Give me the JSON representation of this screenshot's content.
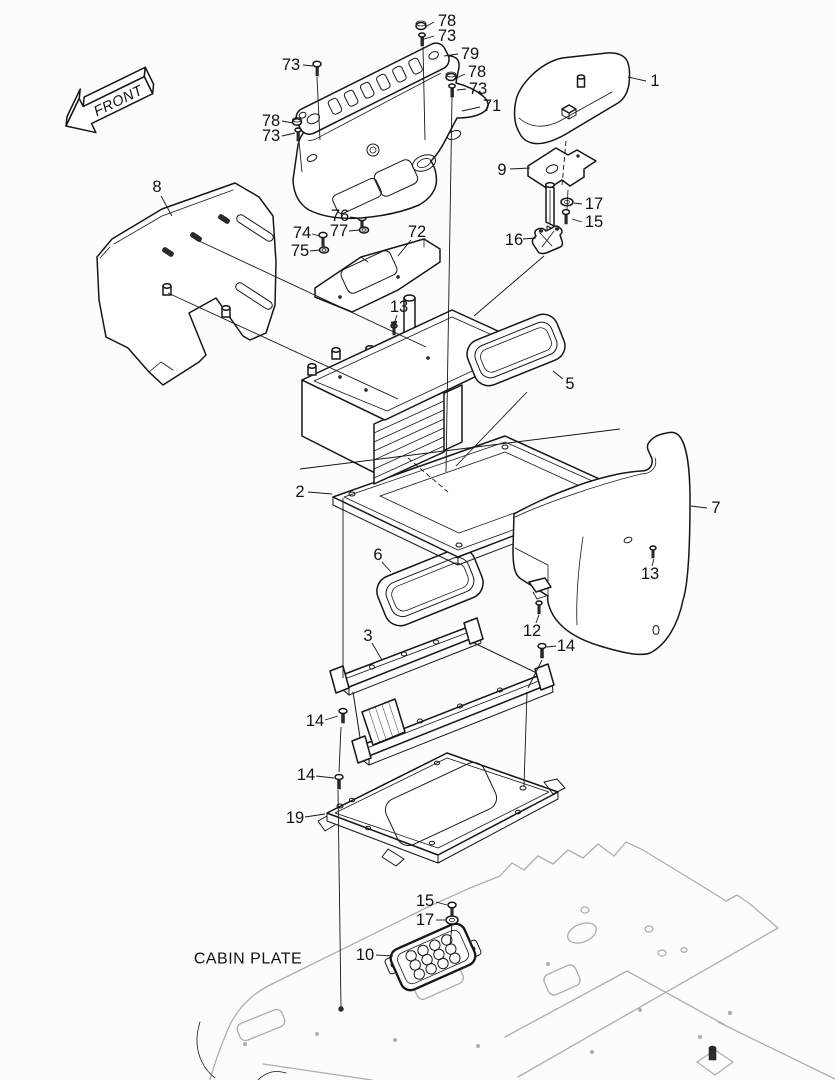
{
  "diagram": {
    "front_arrow_label": "FRONT",
    "cabin_plate_label": "CABIN PLATE",
    "colors": {
      "line": "#161616",
      "cabin_plate_line": "#aeaeae",
      "background": "#fcfcfc"
    },
    "part_labels": [
      {
        "text": "78",
        "tx": 447,
        "ty": 21,
        "lx1": 434,
        "ly1": 22,
        "lx2": 425,
        "ly2": 27
      },
      {
        "text": "73",
        "tx": 447,
        "ty": 36,
        "lx1": 434,
        "ly1": 36,
        "lx2": 424,
        "ly2": 39
      },
      {
        "text": "79",
        "tx": 470,
        "ty": 54,
        "lx1": 458,
        "ly1": 54,
        "lx2": 444,
        "ly2": 56
      },
      {
        "text": "73",
        "tx": 291,
        "ty": 65,
        "lx1": 303,
        "ly1": 65,
        "lx2": 313,
        "ly2": 66
      },
      {
        "text": "78",
        "tx": 477,
        "ty": 72,
        "lx1": 465,
        "ly1": 74,
        "lx2": 454,
        "ly2": 79
      },
      {
        "text": "73",
        "tx": 478,
        "ty": 89,
        "lx1": 466,
        "ly1": 89,
        "lx2": 457,
        "ly2": 90
      },
      {
        "text": "71",
        "tx": 492,
        "ty": 106,
        "lx1": 480,
        "ly1": 107,
        "lx2": 462,
        "ly2": 111
      },
      {
        "text": "78",
        "tx": 271,
        "ty": 121,
        "lx1": 282,
        "ly1": 121,
        "lx2": 293,
        "ly2": 123
      },
      {
        "text": "73",
        "tx": 271,
        "ty": 136,
        "lx1": 282,
        "ly1": 136,
        "lx2": 295,
        "ly2": 133
      },
      {
        "text": "1",
        "tx": 655,
        "ty": 81,
        "lx1": 646,
        "ly1": 81,
        "lx2": 628,
        "ly2": 77
      },
      {
        "text": "9",
        "tx": 502,
        "ty": 170,
        "lx1": 510,
        "ly1": 169,
        "lx2": 530,
        "ly2": 168
      },
      {
        "text": "17",
        "tx": 594,
        "ty": 204,
        "lx1": 582,
        "ly1": 204,
        "lx2": 574,
        "ly2": 203
      },
      {
        "text": "15",
        "tx": 594,
        "ty": 222,
        "lx1": 582,
        "ly1": 222,
        "lx2": 572,
        "ly2": 219
      },
      {
        "text": "16",
        "tx": 514,
        "ty": 240,
        "lx1": 523,
        "ly1": 239,
        "lx2": 536,
        "ly2": 238
      },
      {
        "text": "8",
        "tx": 157,
        "ty": 187,
        "lx1": 161,
        "ly1": 196,
        "lx2": 172,
        "ly2": 216
      },
      {
        "text": "74",
        "tx": 302,
        "ty": 233,
        "lx1": 312,
        "ly1": 234,
        "lx2": 320,
        "ly2": 236
      },
      {
        "text": "75",
        "tx": 300,
        "ty": 251,
        "lx1": 310,
        "ly1": 251,
        "lx2": 320,
        "ly2": 250
      },
      {
        "text": "76",
        "tx": 340,
        "ty": 216,
        "lx1": 350,
        "ly1": 217,
        "lx2": 358,
        "ly2": 218
      },
      {
        "text": "77",
        "tx": 339,
        "ty": 231,
        "lx1": 349,
        "ly1": 231,
        "lx2": 360,
        "ly2": 230
      },
      {
        "text": "72",
        "tx": 417,
        "ty": 232,
        "lx1": 411,
        "ly1": 240,
        "lx2": 398,
        "ly2": 256
      },
      {
        "text": "13",
        "tx": 399,
        "ty": 307,
        "lx1": 397,
        "ly1": 315,
        "lx2": 394,
        "ly2": 324
      },
      {
        "text": "5",
        "tx": 570,
        "ty": 384,
        "lx1": 563,
        "ly1": 379,
        "lx2": 553,
        "ly2": 371
      },
      {
        "text": "2",
        "tx": 300,
        "ty": 492,
        "lx1": 308,
        "ly1": 492,
        "lx2": 332,
        "ly2": 494
      },
      {
        "text": "7",
        "tx": 716,
        "ty": 508,
        "lx1": 707,
        "ly1": 508,
        "lx2": 691,
        "ly2": 506
      },
      {
        "text": "6",
        "tx": 378,
        "ty": 555,
        "lx1": 382,
        "ly1": 562,
        "lx2": 391,
        "ly2": 572
      },
      {
        "text": "13",
        "tx": 650,
        "ty": 574,
        "lx1": 652,
        "ly1": 566,
        "lx2": 654,
        "ly2": 559
      },
      {
        "text": "12",
        "tx": 532,
        "ty": 631,
        "lx1": 536,
        "ly1": 623,
        "lx2": 539,
        "ly2": 615
      },
      {
        "text": "14",
        "tx": 566,
        "ty": 646,
        "lx1": 556,
        "ly1": 646,
        "lx2": 547,
        "ly2": 647
      },
      {
        "text": "3",
        "tx": 368,
        "ty": 636,
        "lx1": 372,
        "ly1": 643,
        "lx2": 382,
        "ly2": 660
      },
      {
        "text": "14",
        "tx": 315,
        "ty": 721,
        "lx1": 325,
        "ly1": 720,
        "lx2": 338,
        "ly2": 716
      },
      {
        "text": "14",
        "tx": 306,
        "ty": 775,
        "lx1": 316,
        "ly1": 776,
        "lx2": 334,
        "ly2": 778
      },
      {
        "text": "19",
        "tx": 295,
        "ty": 818,
        "lx1": 305,
        "ly1": 817,
        "lx2": 325,
        "ly2": 814
      },
      {
        "text": "15",
        "tx": 425,
        "ty": 901,
        "lx1": 436,
        "ly1": 902,
        "lx2": 447,
        "ly2": 905
      },
      {
        "text": "17",
        "tx": 425,
        "ty": 920,
        "lx1": 436,
        "ly1": 920,
        "lx2": 445,
        "ly2": 920
      },
      {
        "text": "10",
        "tx": 365,
        "ty": 955,
        "lx1": 376,
        "ly1": 955,
        "lx2": 393,
        "ly2": 956
      }
    ]
  }
}
